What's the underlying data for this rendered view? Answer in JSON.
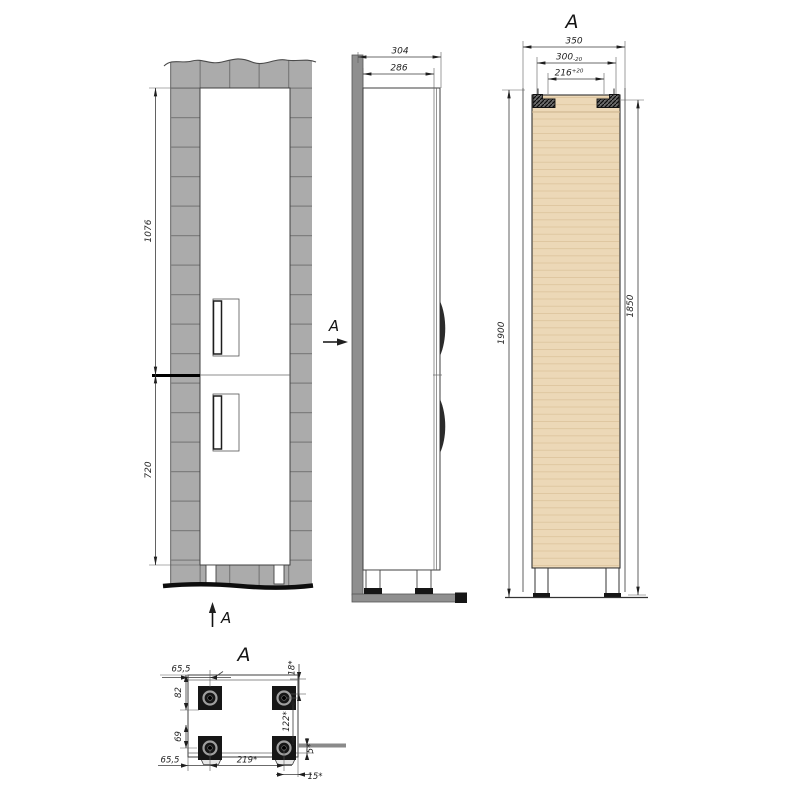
{
  "views": {
    "front": {
      "dim_upper": "1076",
      "dim_lower": "720",
      "arrow_right_label": "A",
      "arrow_bottom_label": "A"
    },
    "side": {
      "dim_depth_outer": "304",
      "dim_depth_inner": "286"
    },
    "section": {
      "label": "A",
      "dim_width": "350",
      "dim_niche": "300",
      "dim_niche_tol": "-20",
      "dim_inner": "216",
      "dim_inner_tol": "+20",
      "dim_height_total": "1900",
      "dim_height_body": "1850"
    },
    "plan": {
      "label": "A",
      "dim_left_top": "65,5",
      "dim_front_inset": "82",
      "dim_rear_inset": "69",
      "dim_left_bottom": "65,5",
      "dim_feet_span": "219*",
      "dim_top_offset": "18*",
      "dim_feet_depth_span": "122*",
      "dim_edge_gap": "5*",
      "dim_right_offset": "15*"
    }
  },
  "colors": {
    "tile": "#ababab",
    "tile_joint": "#7e7e7e",
    "wall": "#8f8f8f",
    "panel": "#ecd8b7",
    "grain": "#dcc39c",
    "cabinet": "#ffffff",
    "foot": "#161616",
    "line": "#3a3a3a"
  }
}
